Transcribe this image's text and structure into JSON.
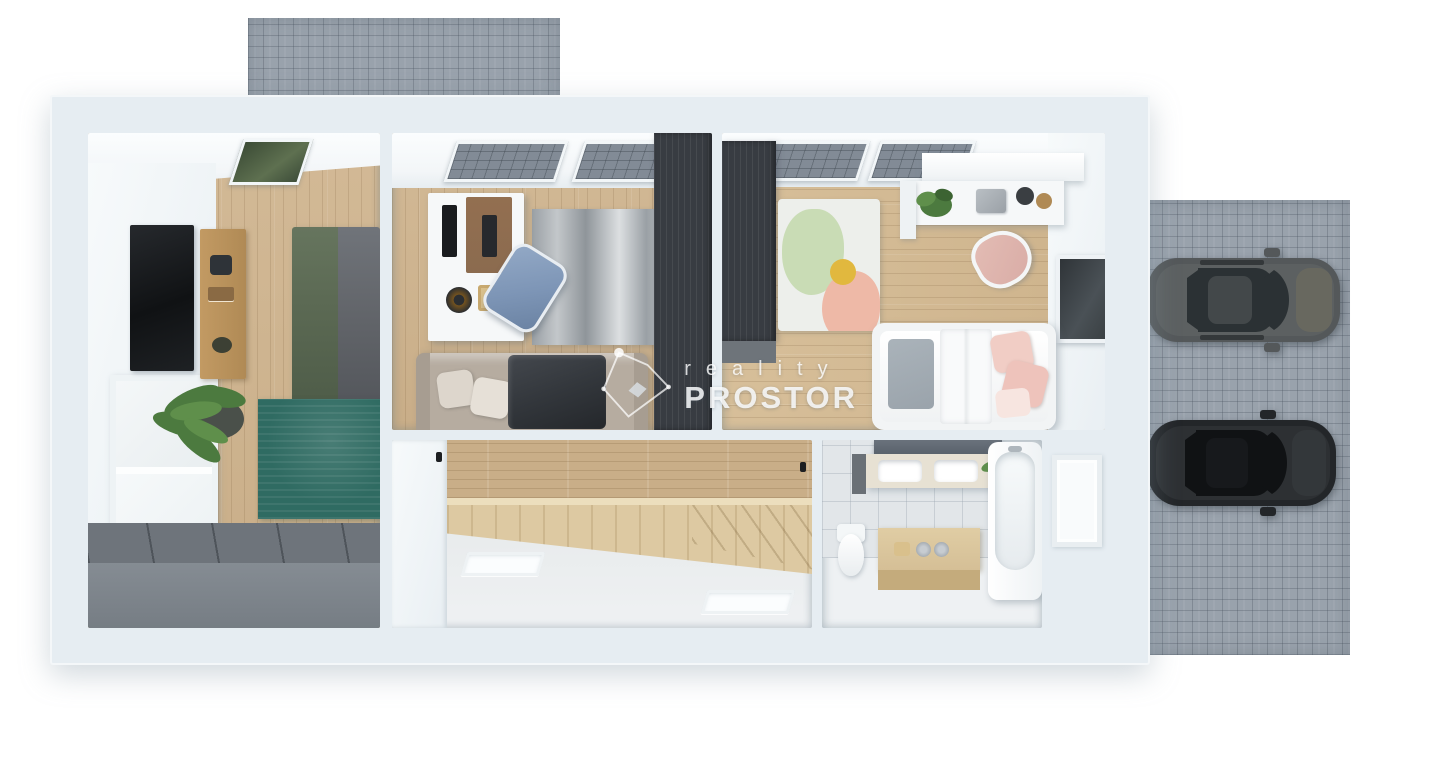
{
  "watermark": {
    "brand_top": "reality",
    "brand_bottom": "PROSTOR"
  },
  "colors": {
    "wall_outer": "#e6edf2",
    "wall_inner": "#f3f6f8",
    "floor_wood": "#cfb48e",
    "floor_wood_kids": "#d4ba92",
    "hall_wall_wood": "#c9ae88",
    "stair_wood": "#ddc9a2",
    "hall_floor": "#e9eced",
    "bath_floor": "#eef1f3",
    "bath_tile": "#e2e6e9",
    "rug_teal": "#2f6b62",
    "rug_gray_a": "#969ca1",
    "rug_gray_b": "#dcdfe1",
    "rug_pastel_base": "#edefeb",
    "rug_pastel_green": "#c9dcb5",
    "rug_pastel_yellow": "#e1b83e",
    "rug_pastel_pink": "#eeb9a7",
    "wardrobe_dark": "#383c42",
    "wardrobe_gray_top": "#6e747b",
    "wardrobe_gray_front": "#858c93",
    "sofa_beige": "#b6aca0",
    "pillow_beige": "#ddd6cc",
    "blanket_dark": "#33373c",
    "bed_green": "#5c6a54",
    "bed_gray": "#63666b",
    "bed_white": "#f2f4f5",
    "kids_pink": "#f1cdc5",
    "kids_gray": "#9aa3ab",
    "chair_blue": "#7d95b6",
    "chair_pink": "#d9aca6",
    "desk_white": "#f6f8f9",
    "desk_mat": "#8b6b4f",
    "sideboard_wood": "#c29a63",
    "box_wood": "#d5bf96",
    "counter_cream": "#e7e1d3",
    "mirror_gray": "#5a626c",
    "tv_black": "#1a1c1f",
    "plant_green": "#4c7a3f",
    "paver": "#99a2ac",
    "car1_body": "#54585a",
    "car1_roof": "#43484a",
    "car1_glass": "#2b3134",
    "car2_body": "#232629",
    "car2_roof": "#17191c",
    "car2_glass": "#101214"
  }
}
